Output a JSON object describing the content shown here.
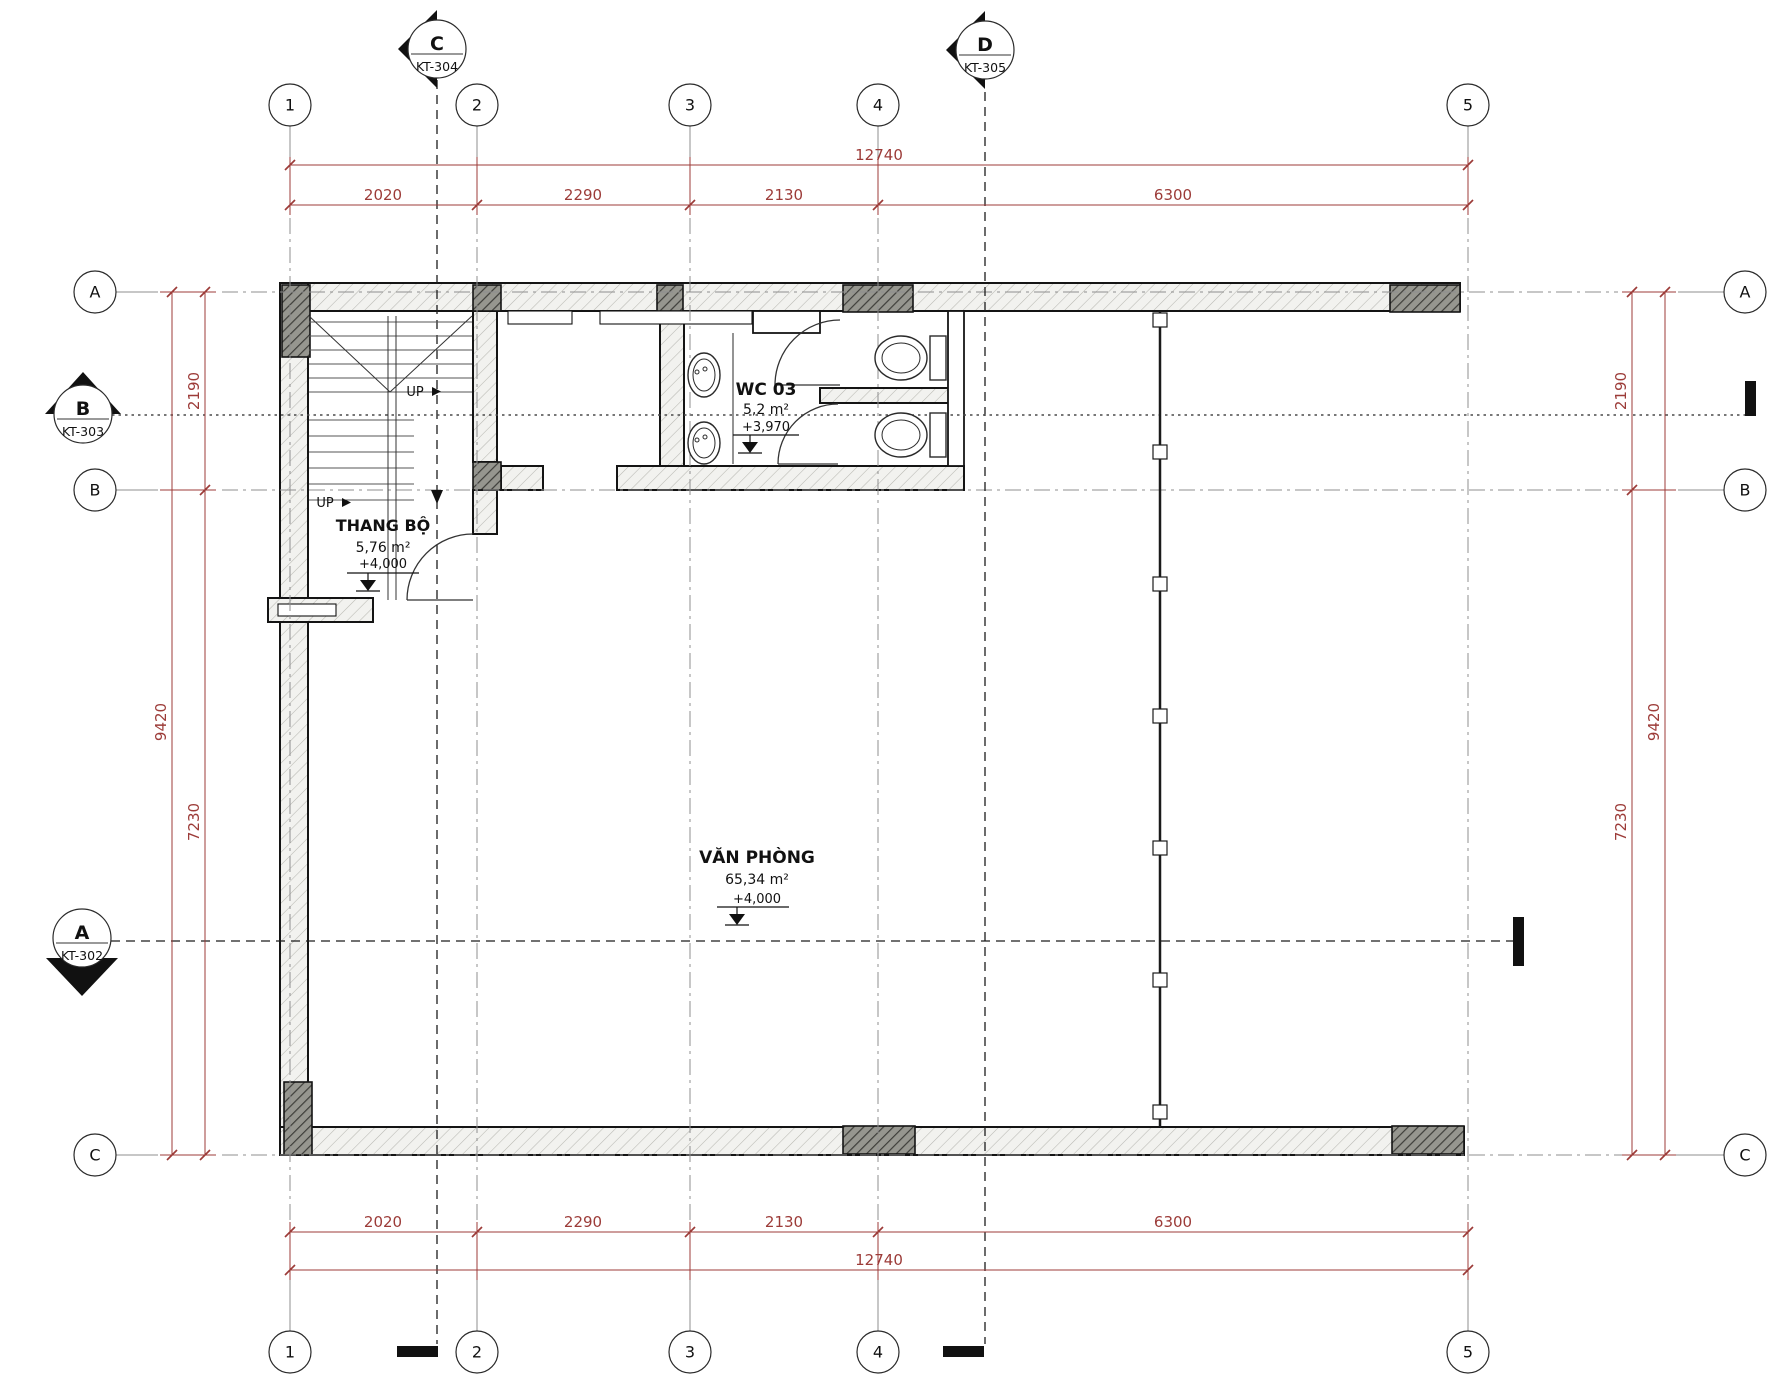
{
  "drawing": {
    "grid": {
      "columns": [
        "1",
        "2",
        "3",
        "4",
        "5"
      ],
      "rows": [
        "A",
        "B",
        "C"
      ]
    },
    "section_markers": [
      {
        "label": "C",
        "sheet": "KT-304"
      },
      {
        "label": "D",
        "sheet": "KT-305"
      },
      {
        "label": "B",
        "sheet": "KT-303"
      },
      {
        "label": "A",
        "sheet": "KT-302"
      }
    ],
    "dimensions": {
      "top_overall": "12740",
      "top_segments": [
        "2020",
        "2290",
        "2130",
        "6300"
      ],
      "bottom_segments": [
        "2020",
        "2290",
        "2130",
        "6300"
      ],
      "bottom_overall": "12740",
      "left": {
        "upper": "2190",
        "lower": "7230",
        "overall": "9420"
      },
      "right": {
        "upper": "2190",
        "lower": "7230",
        "overall": "9420"
      }
    },
    "rooms": {
      "stair": {
        "name": "THANG BỘ",
        "area": "5,76 m²",
        "level": "+4,000"
      },
      "wc": {
        "name": "WC 03",
        "area": "5,2 m²",
        "level": "+3,970"
      },
      "office": {
        "name": "VĂN PHÒNG",
        "area": "65,34 m²",
        "level": "+4,000"
      }
    },
    "annotations": {
      "up": "UP"
    },
    "colors": {
      "dimension": "#9c3b38",
      "grid_line": "#8f8f8f",
      "wall_line": "#141414"
    }
  }
}
